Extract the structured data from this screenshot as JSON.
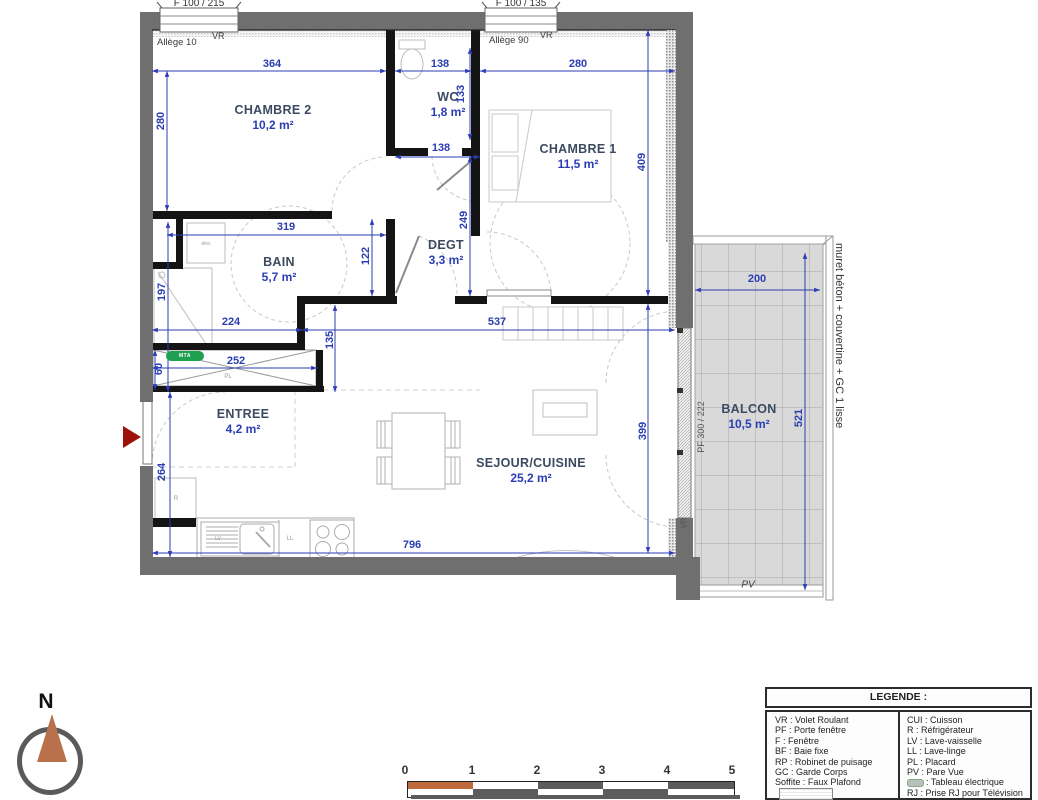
{
  "windows": {
    "w1": "F 100 / 215",
    "w2": "F 100 / 135"
  },
  "annotations": {
    "vr_top1": "VR",
    "vr_top2": "VR",
    "vr_pf": "VR",
    "allege10": "Allège 10",
    "allege90": "Allège 90",
    "pf_door": "PF 300 / 222",
    "muret_note": "muret béton + couvertine + GC 1 lisse",
    "pv": "PV",
    "pl": "PL",
    "mta": "MTA",
    "ll": "LL",
    "lv": "LV",
    "refrigerator": "R",
    "elec": "élec"
  },
  "rooms": {
    "chambre2": {
      "name": "CHAMBRE 2",
      "area": "10,2 m²"
    },
    "wc": {
      "name": "WC",
      "area": "1,8 m²"
    },
    "chambre1": {
      "name": "CHAMBRE 1",
      "area": "11,5 m²"
    },
    "bain": {
      "name": "BAIN",
      "area": "5,7 m²"
    },
    "degt": {
      "name": "DEGT",
      "area": "3,3 m²"
    },
    "entree": {
      "name": "ENTREE",
      "area": "4,2 m²"
    },
    "sejour": {
      "name": "SEJOUR/CUISINE",
      "area": "25,2 m²"
    },
    "balcon": {
      "name": "BALCON",
      "area": "10,5 m²"
    }
  },
  "dimensions": {
    "d364": "364",
    "d138a": "138",
    "d280h": "280",
    "d280v": "280",
    "d133": "133",
    "d138b": "138",
    "d409": "409",
    "d319": "319",
    "d249": "249",
    "d122": "122",
    "d197": "197",
    "d224": "224",
    "d537": "537",
    "d135": "135",
    "d252": "252",
    "d60": "60",
    "d264": "264",
    "d796": "796",
    "d399": "399",
    "d200": "200",
    "d521": "521"
  },
  "legend": {
    "title": "LEGENDE :",
    "left": [
      "VR : Volet Roulant",
      "PF : Porte fenêtre",
      "F : Fenêtre",
      "BF : Baie fixe",
      "RP : Robinet de puisage",
      "GC : Garde Corps",
      "Soffite : Faux Plafond",
      "Caniveaux"
    ],
    "right": [
      "CUI : Cuisson",
      "R : Réfrigérateur",
      "LV : Lave-vaisselle",
      "LL : Lave-linge",
      "PL : Placard",
      "PV : Pare Vue",
      ": Tableau électrique",
      "RJ : Prise RJ pour Télévision Séjour"
    ]
  },
  "compass": {
    "north": "N"
  },
  "scalebar": {
    "ticks": [
      "0",
      "1",
      "2",
      "3",
      "4",
      "5"
    ]
  },
  "colors": {
    "exterior_wall": "#6f6f6f",
    "interior_wall": "#141414",
    "dimension_blue": "#2b3db2",
    "room_name": "#3c4a61",
    "scale_orange": "#bf6a3c",
    "mta_green": "#1ea050",
    "entry_arrow_red": "#9c1208",
    "balcony_tile": "#d9d9d9"
  }
}
